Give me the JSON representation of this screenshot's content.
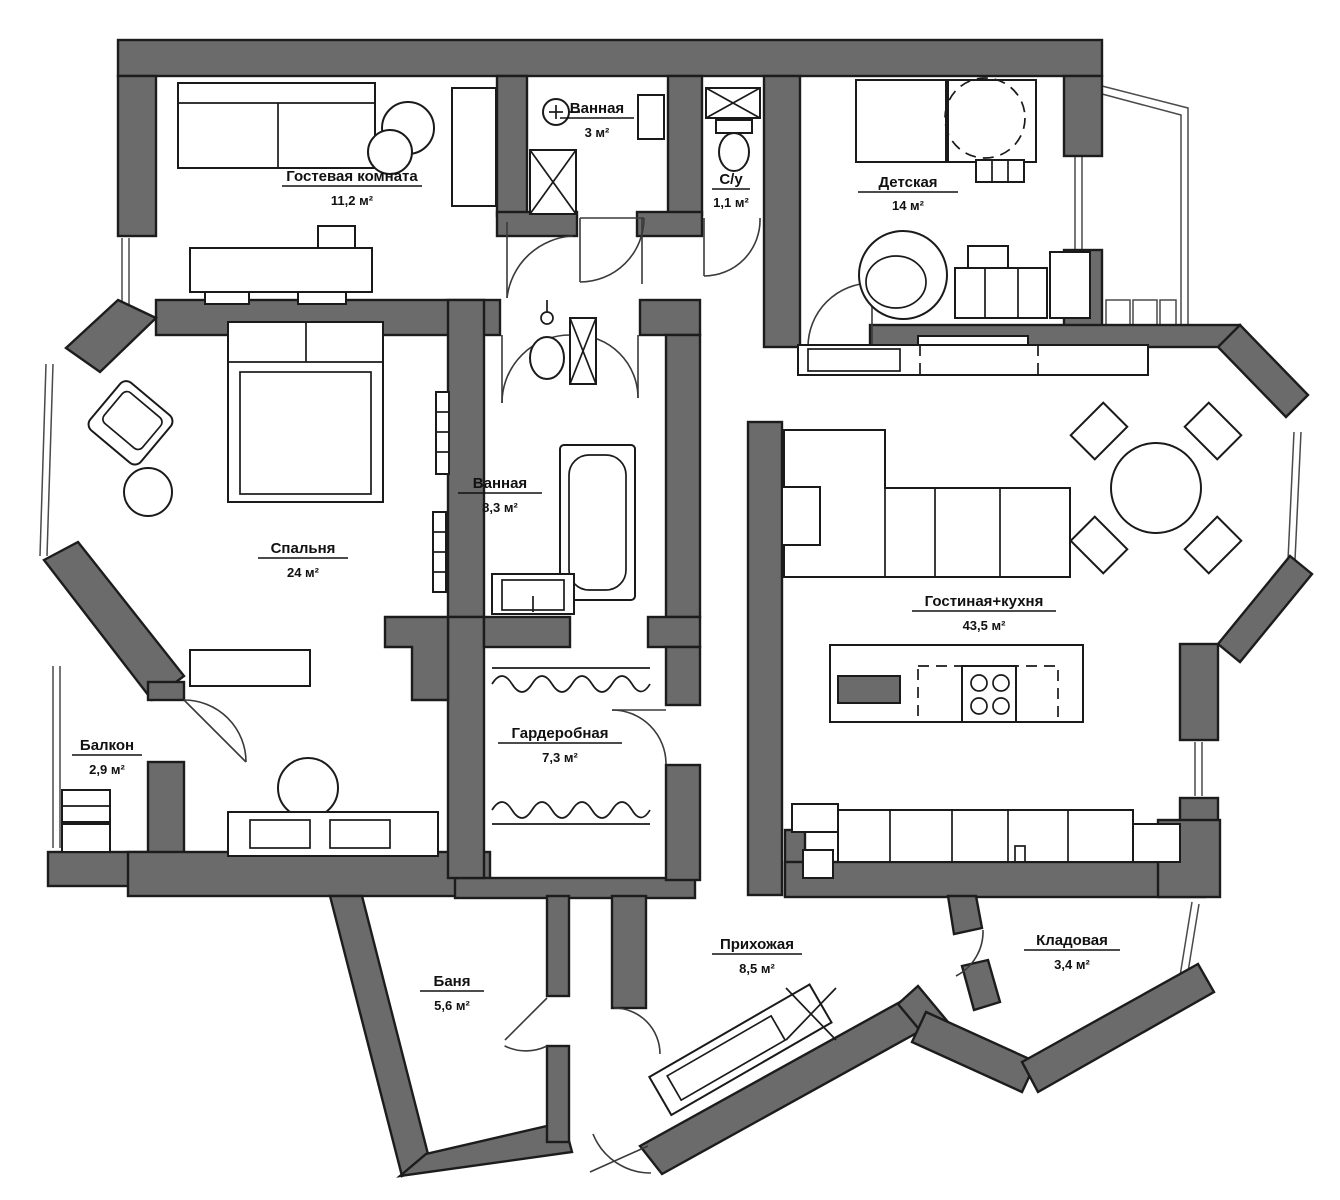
{
  "plan_title": "Apartment floor plan",
  "colors": {
    "wall": "#6b6b6b",
    "outline": "#1c1c1c",
    "background": "#ffffff",
    "furniture_line": "#1a1a1a"
  },
  "rooms": [
    {
      "key": "guest-room",
      "name": "Гостевая комната",
      "area": "11,2 м²"
    },
    {
      "key": "bath-small",
      "name": "Ванная",
      "area": "3 м²"
    },
    {
      "key": "wc",
      "name": "С/у",
      "area": "1,1 м²"
    },
    {
      "key": "kids-room",
      "name": "Детская",
      "area": "14 м²"
    },
    {
      "key": "bedroom",
      "name": "Спальня",
      "area": "24 м²"
    },
    {
      "key": "bath-main",
      "name": "Ванная",
      "area": "8,3 м²"
    },
    {
      "key": "living-kitchen",
      "name": "Гостиная+кухня",
      "area": "43,5 м²"
    },
    {
      "key": "balcony",
      "name": "Балкон",
      "area": "2,9 м²"
    },
    {
      "key": "wardrobe",
      "name": "Гардеробная",
      "area": "7,3 м²"
    },
    {
      "key": "sauna",
      "name": "Баня",
      "area": "5,6 м²"
    },
    {
      "key": "hallway",
      "name": "Прихожая",
      "area": "8,5 м²"
    },
    {
      "key": "storage",
      "name": "Кладовая",
      "area": "3,4 м²"
    }
  ]
}
